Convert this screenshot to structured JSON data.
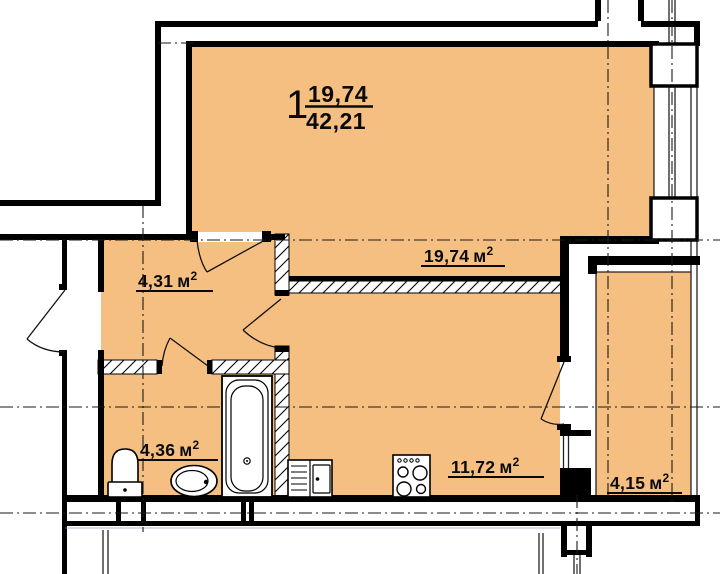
{
  "title_block": {
    "rooms_count": "1",
    "living_area": "19,74",
    "total_area": "42,21"
  },
  "units": {
    "m": "м",
    "sup": "2"
  },
  "rooms": {
    "living": {
      "name": "living-room",
      "area": "19,74"
    },
    "hall": {
      "name": "hallway",
      "area": "4,31"
    },
    "bath": {
      "name": "bathroom",
      "area": "4,36"
    },
    "kitchen": {
      "name": "kitchen",
      "area": "11,72"
    },
    "balcony": {
      "name": "balcony",
      "area": "4,15"
    }
  },
  "fixtures": [
    "toilet",
    "wash-basin",
    "bathtub",
    "kitchen-sink",
    "stove"
  ],
  "colors": {
    "floor": "#F6BF82",
    "wall": "#000000",
    "axis": "#1A1A1A",
    "underlay": "#8F9BBD"
  }
}
